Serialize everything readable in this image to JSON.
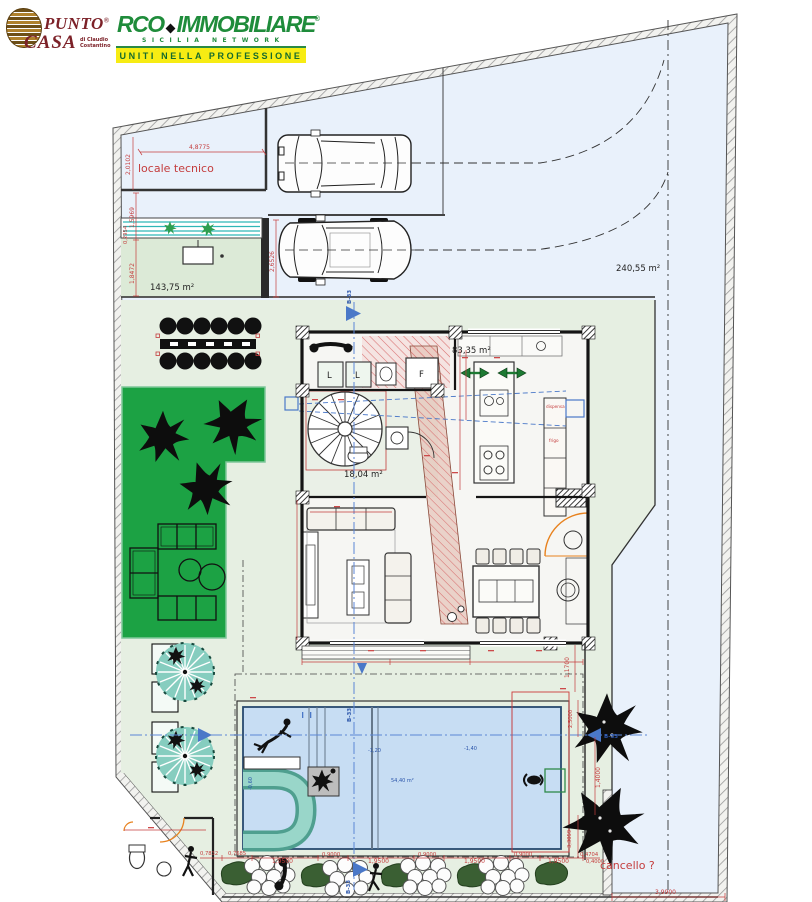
{
  "header": {
    "puntocasa": {
      "word1": "PUNTO",
      "word2": "CASA",
      "reg": "®",
      "sub1": "di Claudio",
      "sub2": "Costantino"
    },
    "arco": {
      "a_word": "RCO",
      "word2": "IMMOBILIARE",
      "reg": "®",
      "network": "SICILIA NETWORK",
      "banner": "UNITI NELLA PROFESSIONE"
    }
  },
  "plan": {
    "locale_tecnico": "locale tecnico",
    "cancello": "cancello ?",
    "section_label": "B-33",
    "areas": {
      "lot": "240,55 m²",
      "paving": "143,75 m²",
      "house": "83,35 m²",
      "stairs": "18,04 m²",
      "pool": "54,40 m²"
    },
    "appliances": {
      "washer1": "L",
      "washer2": "L",
      "fridge": "F"
    },
    "kitchen": {
      "pantry": "dispensa",
      "fridge_col": "frigo"
    },
    "pool_depths": {
      "steps": "-0,60",
      "mid": "-1,20",
      "deep": "-1,40"
    },
    "dims": {
      "d4_8775": "4,8775",
      "d2_0102": "2,0102",
      "d1_5969": "1,5969",
      "d0_2954": "0,2954",
      "d1_8472": "1,8472",
      "d2_6526": "2,6526",
      "d1_1700": "1,1700",
      "d2_5000": "2,5000",
      "d1_4000": "1,4000",
      "d3_3059": "3,3059",
      "d0_4704": "0,4704",
      "d3_9900": "3,9900",
      "bottom": [
        "0,7832",
        "0,7685",
        "1,9500",
        "0,9000",
        "1,9500",
        "0,9000",
        "1,9500",
        "0,9000",
        "1,9500",
        "0,4000"
      ]
    }
  }
}
